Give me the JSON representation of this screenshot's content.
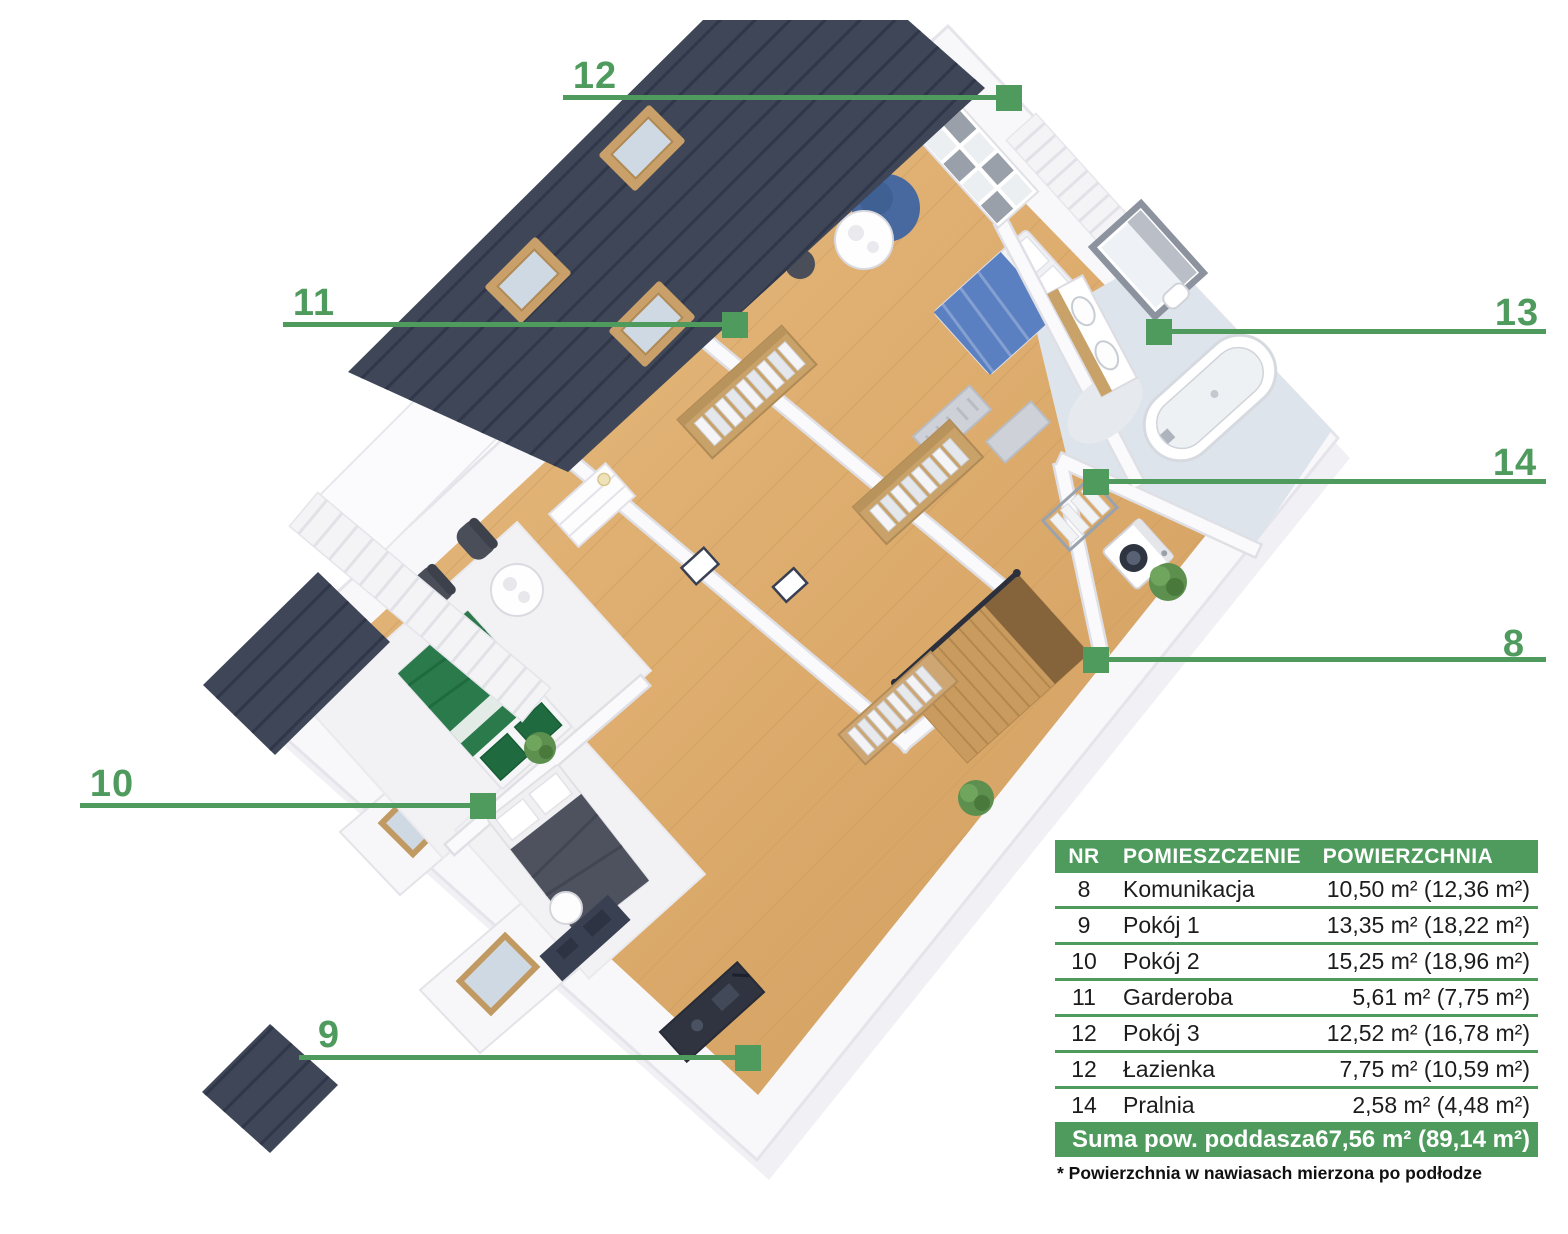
{
  "colors": {
    "accent": "#4f9b5e",
    "roof": "#3e4657",
    "wood": "#ddae72"
  },
  "annotations": [
    {
      "label": "12"
    },
    {
      "label": "11"
    },
    {
      "label": "13"
    },
    {
      "label": "14"
    },
    {
      "label": "8"
    },
    {
      "label": "10"
    },
    {
      "label": "9"
    }
  ],
  "legend": {
    "headers": {
      "nr": "NR",
      "room": "POMIESZCZENIE",
      "area": "POWIERZCHNIA"
    },
    "rows": [
      {
        "nr": "8",
        "room": "Komunikacja",
        "area": "10,50 m² (12,36 m²)"
      },
      {
        "nr": "9",
        "room": "Pokój 1",
        "area": "13,35 m² (18,22 m²)"
      },
      {
        "nr": "10",
        "room": "Pokój 2",
        "area": "15,25 m² (18,96 m²)"
      },
      {
        "nr": "11",
        "room": "Garderoba",
        "area": "5,61 m² (7,75 m²)"
      },
      {
        "nr": "12",
        "room": "Pokój 3",
        "area": "12,52 m² (16,78 m²)"
      },
      {
        "nr": "12",
        "room": "Łazienka",
        "area": "7,75 m² (10,59 m²)"
      },
      {
        "nr": "14",
        "room": "Pralnia",
        "area": "2,58 m² (4,48 m²)"
      }
    ],
    "summary": {
      "label": "Suma pow. poddasza",
      "area": "67,56 m² (89,14 m²)"
    },
    "footnote": "* Powierzchnia w nawiasach mierzona po podłodze"
  }
}
